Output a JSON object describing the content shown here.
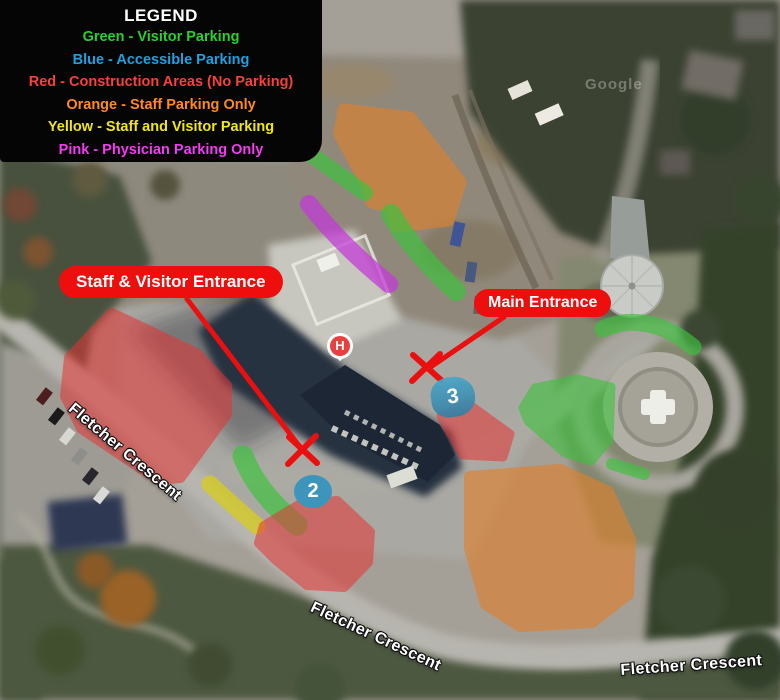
{
  "legend": {
    "title": "LEGEND",
    "items": [
      {
        "label": "Green - Visitor Parking",
        "color": "#2bd12b"
      },
      {
        "label": "Blue - Accessible Parking",
        "color": "#1fa0e0"
      },
      {
        "label": "Red - Construction Areas (No Parking)",
        "color": "#f4423c"
      },
      {
        "label": "Orange - Staff Parking Only",
        "color": "#ff8b1f"
      },
      {
        "label": "Yellow - Staff and Visitor Parking",
        "color": "#f2e713"
      },
      {
        "label": "Pink - Physician Parking Only",
        "color": "#f43cf0"
      }
    ]
  },
  "callouts": {
    "staff_visitor": "Staff & Visitor Entrance",
    "main": "Main Entrance"
  },
  "markers": {
    "hospital": "H",
    "zone2": "2",
    "zone3": "3"
  },
  "road_label": "Fletcher Crescent",
  "watermark": "Google",
  "map_colors": {
    "visitor_green": "#3cc23c",
    "accessible_blue": "#3b92b8",
    "construction_red": "#e43434",
    "staff_orange": "#e0802a",
    "staff_visitor_yellow": "#d6cc20",
    "physician_pink": "#c438d8",
    "callout_red": "#ee0e0e"
  }
}
